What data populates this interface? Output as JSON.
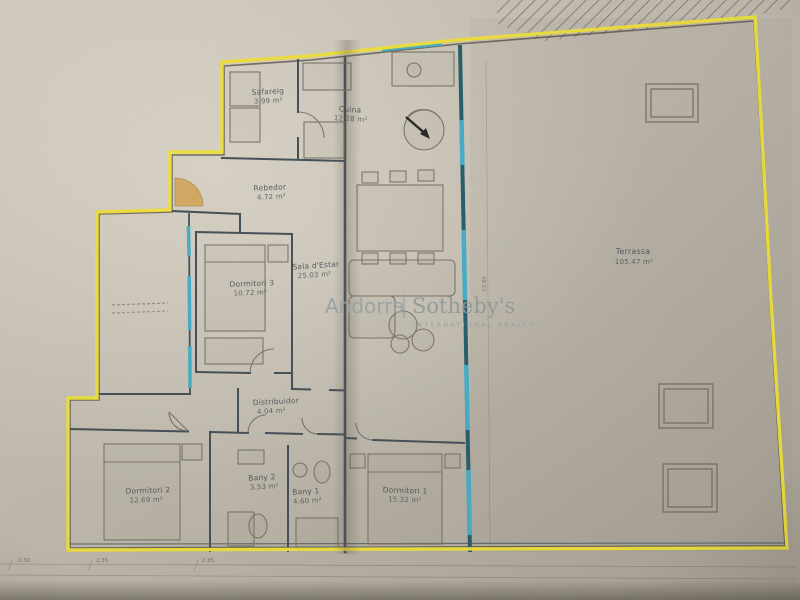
{
  "document": {
    "type": "apartment-floor-plan-photo",
    "boundary_highlight_color": "#f0e23b",
    "entrance_highlight_color": "#d2a14a",
    "wall_color": "#46525a",
    "window_wall_color": "#2f7f95",
    "paper_color": "#c9c3b6"
  },
  "watermark": {
    "brand_left": "Andorra",
    "brand_right": "Sotheby's",
    "brand_sub": "INTERNATIONAL REALTY"
  },
  "rooms": [
    {
      "name": "Safareig",
      "area": "3.99 m²"
    },
    {
      "name": "Cuina",
      "area": "12.28 m²"
    },
    {
      "name": "Rebedor",
      "area": "4.72 m²"
    },
    {
      "name": "Dormitori 3",
      "area": "10.72 m²"
    },
    {
      "name": "Sala d'Estar",
      "area": "25.03 m²"
    },
    {
      "name": "Terrassa",
      "area": "105.47 m²"
    },
    {
      "name": "Distribuidor",
      "area": "4.04 m²"
    },
    {
      "name": "Dormitori 2",
      "area": "12.69 m²"
    },
    {
      "name": "Bany 2",
      "area": "3.53 m²"
    },
    {
      "name": "Bany 1",
      "area": "4.60 m²"
    },
    {
      "name": "Dormitori 1",
      "area": "15.32 m²"
    }
  ],
  "dimensions": {
    "right_wall": "13.80",
    "bottom_tick_1": "0.30",
    "bottom_tick_2": "2.35",
    "bottom_tick_3": "2.85"
  }
}
